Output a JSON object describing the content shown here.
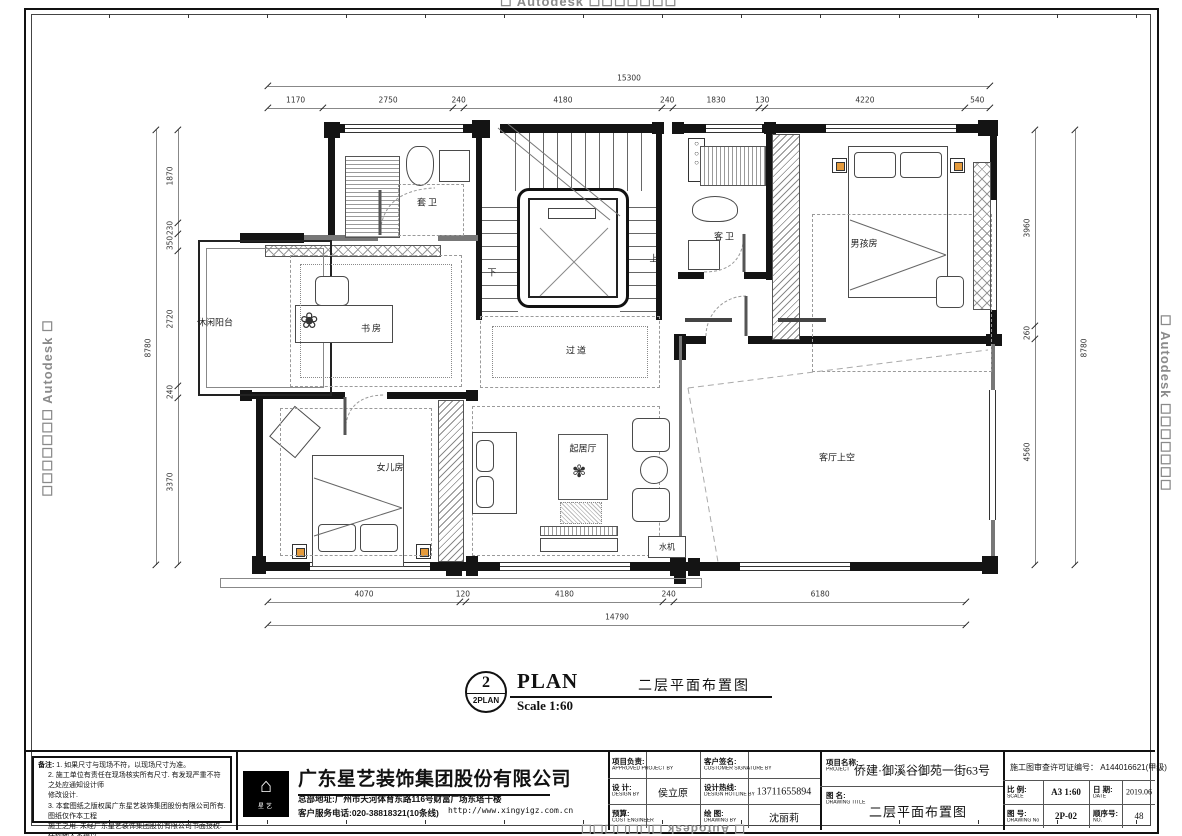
{
  "watermark": {
    "brand": "Autodesk",
    "boxes": "☐☐☐☐☐☐☐",
    "box": "☐"
  },
  "dims": {
    "top_overall": "15300",
    "top_segments": [
      "1170",
      "2750",
      "240",
      "4180",
      "240",
      "1830",
      "130",
      "4220",
      "540"
    ],
    "left_overall": "8780",
    "left_segments": [
      "1870",
      "230",
      "350",
      "2720",
      "240",
      "3370"
    ],
    "right_overall": "8780",
    "right_segments": [
      "3960",
      "260",
      "4560"
    ],
    "bottom_overall": "14790",
    "bottom_segments": [
      "4070",
      "120",
      "4180",
      "240",
      "6180"
    ]
  },
  "rooms": {
    "balcony": "休闲阳台",
    "study": "书房",
    "bath1": "套卫",
    "bath2": "客卫",
    "corridor": "过道",
    "living": "起居厅",
    "void": "客厅上空",
    "boy": "男孩房",
    "girl": "女儿房",
    "water": "水机",
    "up": "上",
    "down": "下"
  },
  "plan_title": {
    "num": "2",
    "sub": "2PLAN",
    "word": "PLAN",
    "scale": "Scale  1:60",
    "cn": "二层平面布置图"
  },
  "notes": {
    "label": "备注:",
    "l1": "1. 如果尺寸与现场不符，以现场尺寸为准。",
    "l2": "2. 施工单位有责任在现场核实所有尺寸. 有发现严重不符之处应通知设计师",
    "l3": "修改设计.",
    "l4": "3. 本套图纸之版权属广东星艺装饰集团股份有限公司所有. 图纸仅作本工程",
    "l5": "施工之用. 未经广东星艺装饰集团股份有限公司书面授权. 任何他人不得以",
    "l6": "任何方式复制本套图纸之任何部分. 亦不得将本套图纸用于其他任何用途。"
  },
  "company": {
    "name": "广东星艺装饰集团股份有限公司",
    "address": "总部地址:广州市天河体育东路116号财富广场东塔十楼",
    "phone": "客户服务电话:020-38818321(10条线)",
    "website": "http://www.xingyigz.com.cn",
    "logo_caption": "星艺"
  },
  "titleblock": {
    "approved_cn": "项目负责:",
    "approved_en": "APPROVED PROJECT BY",
    "approved_value": "",
    "customer_cn": "客户签名:",
    "customer_en": "CUSTOMER SIGNATURE BY",
    "customer_value": "",
    "design_cn": "设 计:",
    "design_en": "DESIGN BY",
    "design_value": "侯立原",
    "hotline_cn": "设计热线:",
    "hotline_en": "DESIGN HOTLINE BY",
    "hotline_value": "13711655894",
    "cost_cn": "预算:",
    "cost_en": "COST ENGINEER",
    "cost_value": "",
    "drawing_cn": "绘 图:",
    "drawing_en": "DRAWING BY",
    "drawing_value": "沈丽莉",
    "project_cn": "项目名称:",
    "project_en": "PROJECT",
    "project_value": "侨建·御溪谷御苑一街63号",
    "title_cn": "图 名:",
    "title_en": "DRAWING TITLE",
    "title_value": "二层平面布置图",
    "permit": "施工图审查许可证编号： A144016621(甲级)",
    "scale_cn": "比 例:",
    "scale_en": "SCALE",
    "scale_value": "A3 1:60",
    "date_cn": "日 期:",
    "date_en": "DATE",
    "date_value": "2019.06",
    "no_cn": "图 号:",
    "no_en": "DRAWING No",
    "no_value": "2P-02",
    "seq_cn": "顺序号:",
    "seq_en": "NO.",
    "seq_value": "48"
  }
}
